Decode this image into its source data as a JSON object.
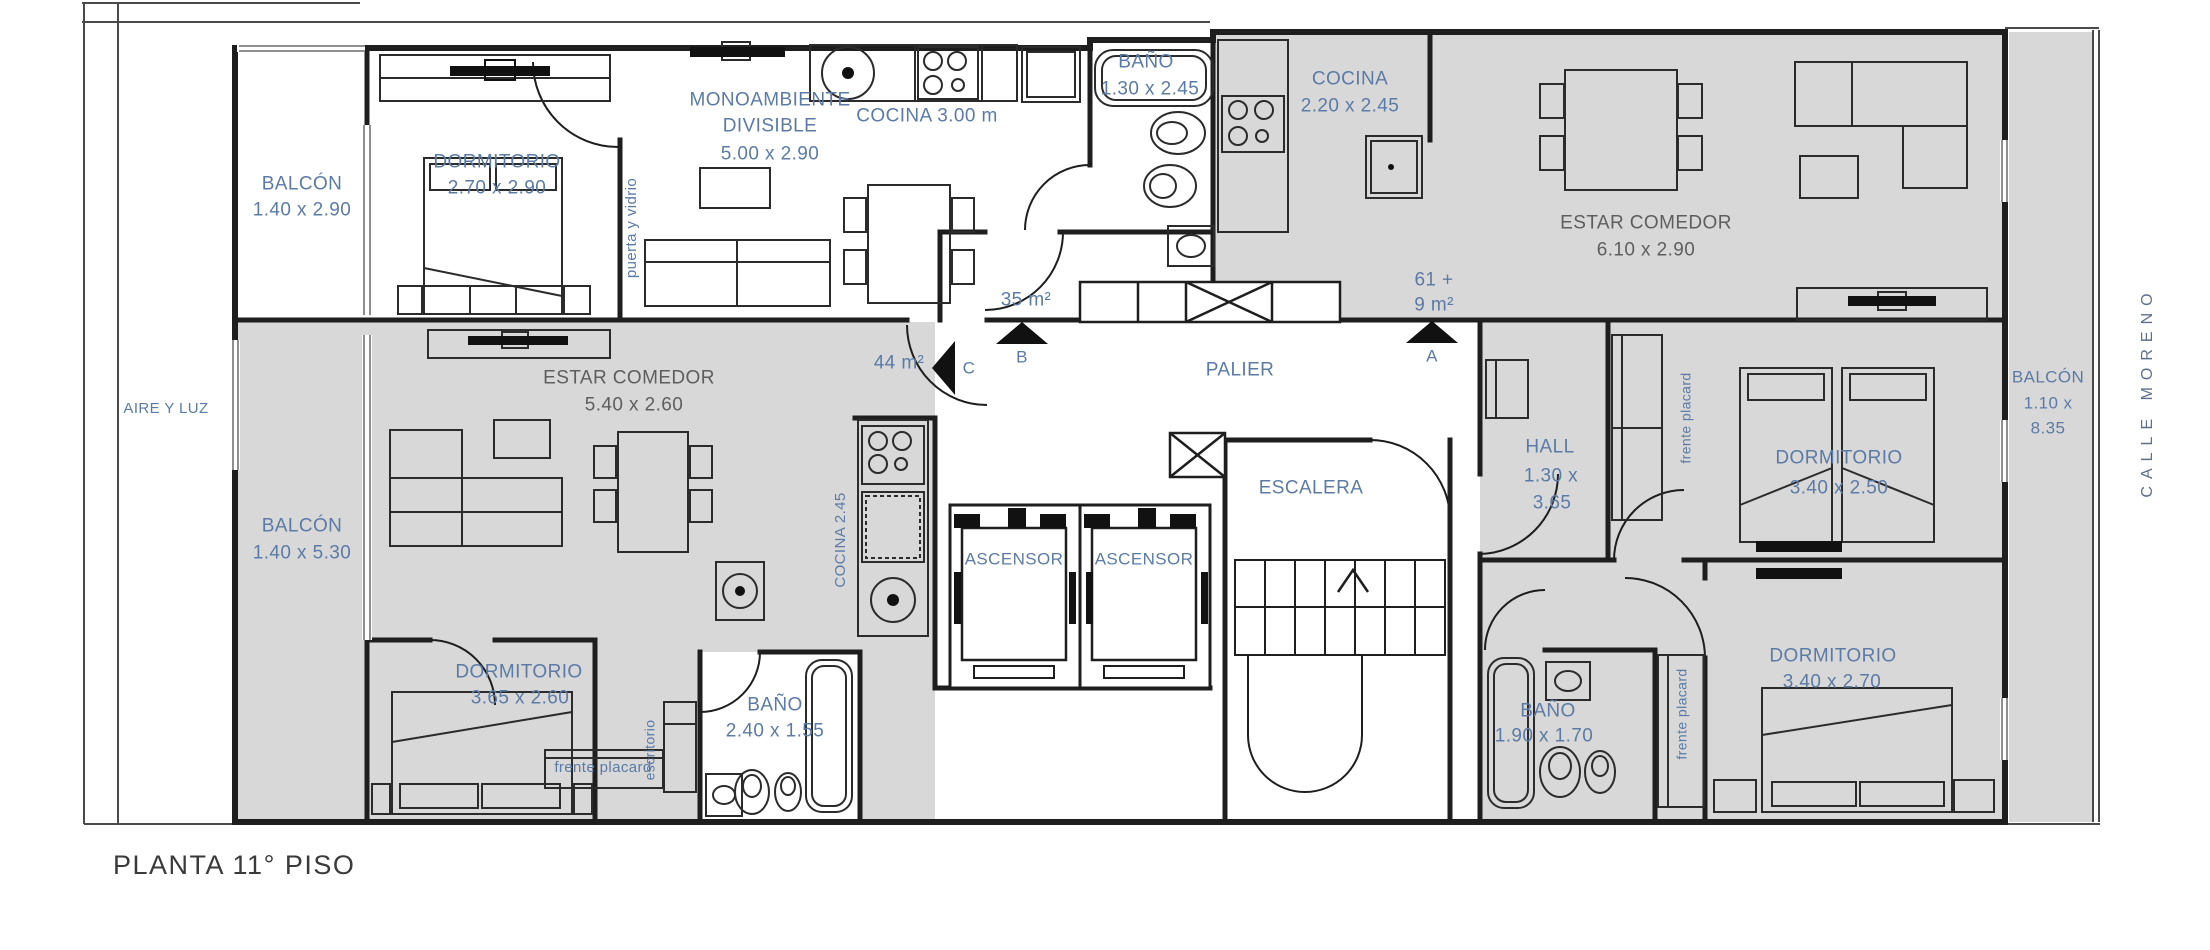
{
  "site": {
    "title": "PLANTA 11° PISO",
    "aire_y_luz": "AIRE Y LUZ",
    "street": "CALLE MORENO"
  },
  "common": {
    "palier": "PALIER",
    "escalera": "ESCALERA",
    "ascensor1": "ASCENSOR",
    "ascensor2": "ASCENSOR"
  },
  "units": {
    "b": {
      "marker": "B",
      "area": "35 m²",
      "balcon_name": "BALCÓN",
      "balcon_dims": "1.40 x 2.90",
      "dorm_name": "DORMITORIO",
      "dorm_dims": "2.70 x 2.90",
      "mono1": "MONOAMBIENTE",
      "mono2": "DIVISIBLE",
      "mono_dims": "5.00 x 2.90",
      "puerta_vidrio": "puerta y vidrio",
      "cocina": "COCINA 3.00 m",
      "bano_name": "BAÑO",
      "bano_dims": "1.30 x 2.45"
    },
    "c": {
      "marker": "C",
      "area": "44 m²",
      "estar_name": "ESTAR COMEDOR",
      "estar_dims": "5.40 x 2.60",
      "balcon_name": "BALCÓN",
      "balcon_dims": "1.40 x 5.30",
      "cocina": "COCINA 2.45",
      "dorm_name": "DORMITORIO",
      "dorm_dims": "3.65 x 2.60",
      "escritorio": "escritorio",
      "placard": "frente placard",
      "bano_name": "BAÑO",
      "bano_dims": "2.40 x 1.55"
    },
    "a": {
      "marker": "A",
      "area1": "61 +",
      "area2": "9 m²",
      "cocina_name": "COCINA",
      "cocina_dims": "2.20 x 2.45",
      "estar_name": "ESTAR COMEDOR",
      "estar_dims": "6.10 x 2.90",
      "hall_name": "HALL",
      "hall_dims1": "1.30 x",
      "hall_dims2": "3.65",
      "placard_upper": "frente placard",
      "placard_lower": "frente placard",
      "dorm1_name": "DORMITORIO",
      "dorm1_dims": "3.40 x 2.50",
      "dorm2_name": "DORMITORIO",
      "dorm2_dims": "3.40 x 2.70",
      "bano_name": "BAÑO",
      "bano_dims": "1.90 x 1.70",
      "balcon_name": "BALCÓN",
      "balcon_dims1": "1.10 x",
      "balcon_dims2": "8.35"
    }
  },
  "colors": {
    "label_blue": "#5b7ba6",
    "label_gray": "#5e5e5e",
    "floor_gray": "#d8d8d8",
    "wall": "#1e1e1e"
  }
}
